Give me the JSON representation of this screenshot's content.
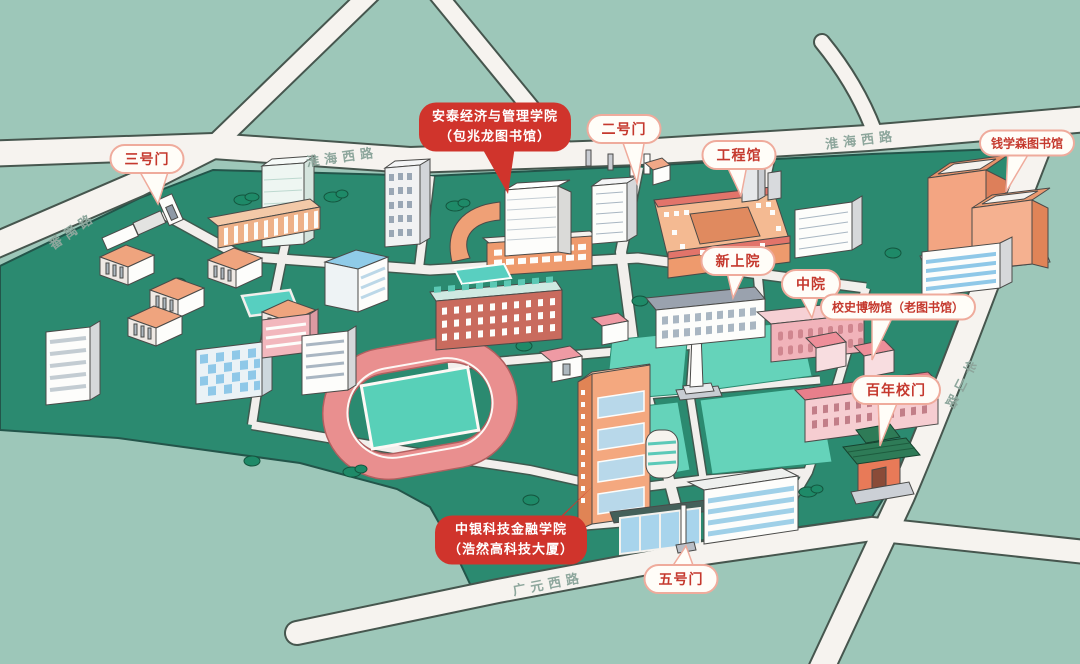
{
  "roads": {
    "huaihai_west": "淮海西路",
    "panyu": "番禺路",
    "huashan": "华山路",
    "guangyuan_west": "广元西路"
  },
  "callouts": {
    "antai": {
      "line1": "安泰经济与管理学院",
      "line2": "（包兆龙图书馆）"
    },
    "zhongyin": {
      "line1": "中银科技金融学院",
      "line2": "（浩然高科技大厦）"
    },
    "gate3": "三号门",
    "gate2": "二号门",
    "gongchengguan": "工程馆",
    "qianxuesen_library": "钱学森图书馆",
    "xinshangyuan": "新上院",
    "zhongyuan": "中院",
    "history_museum": "校史博物馆（老图书馆）",
    "bainian_gate": "百年校门",
    "gate5": "五号门"
  },
  "colors": {
    "background": "#9dc7b9",
    "campus_green": "#2b8a70",
    "lawn": "#65d3ba",
    "road": "#f6f3ef",
    "track_ring": "#e98f8f",
    "track_field": "#58d0b8",
    "red_label_bg": "#d0342c",
    "label_text_red": "#c5392e",
    "road_text": "#8da69c"
  }
}
